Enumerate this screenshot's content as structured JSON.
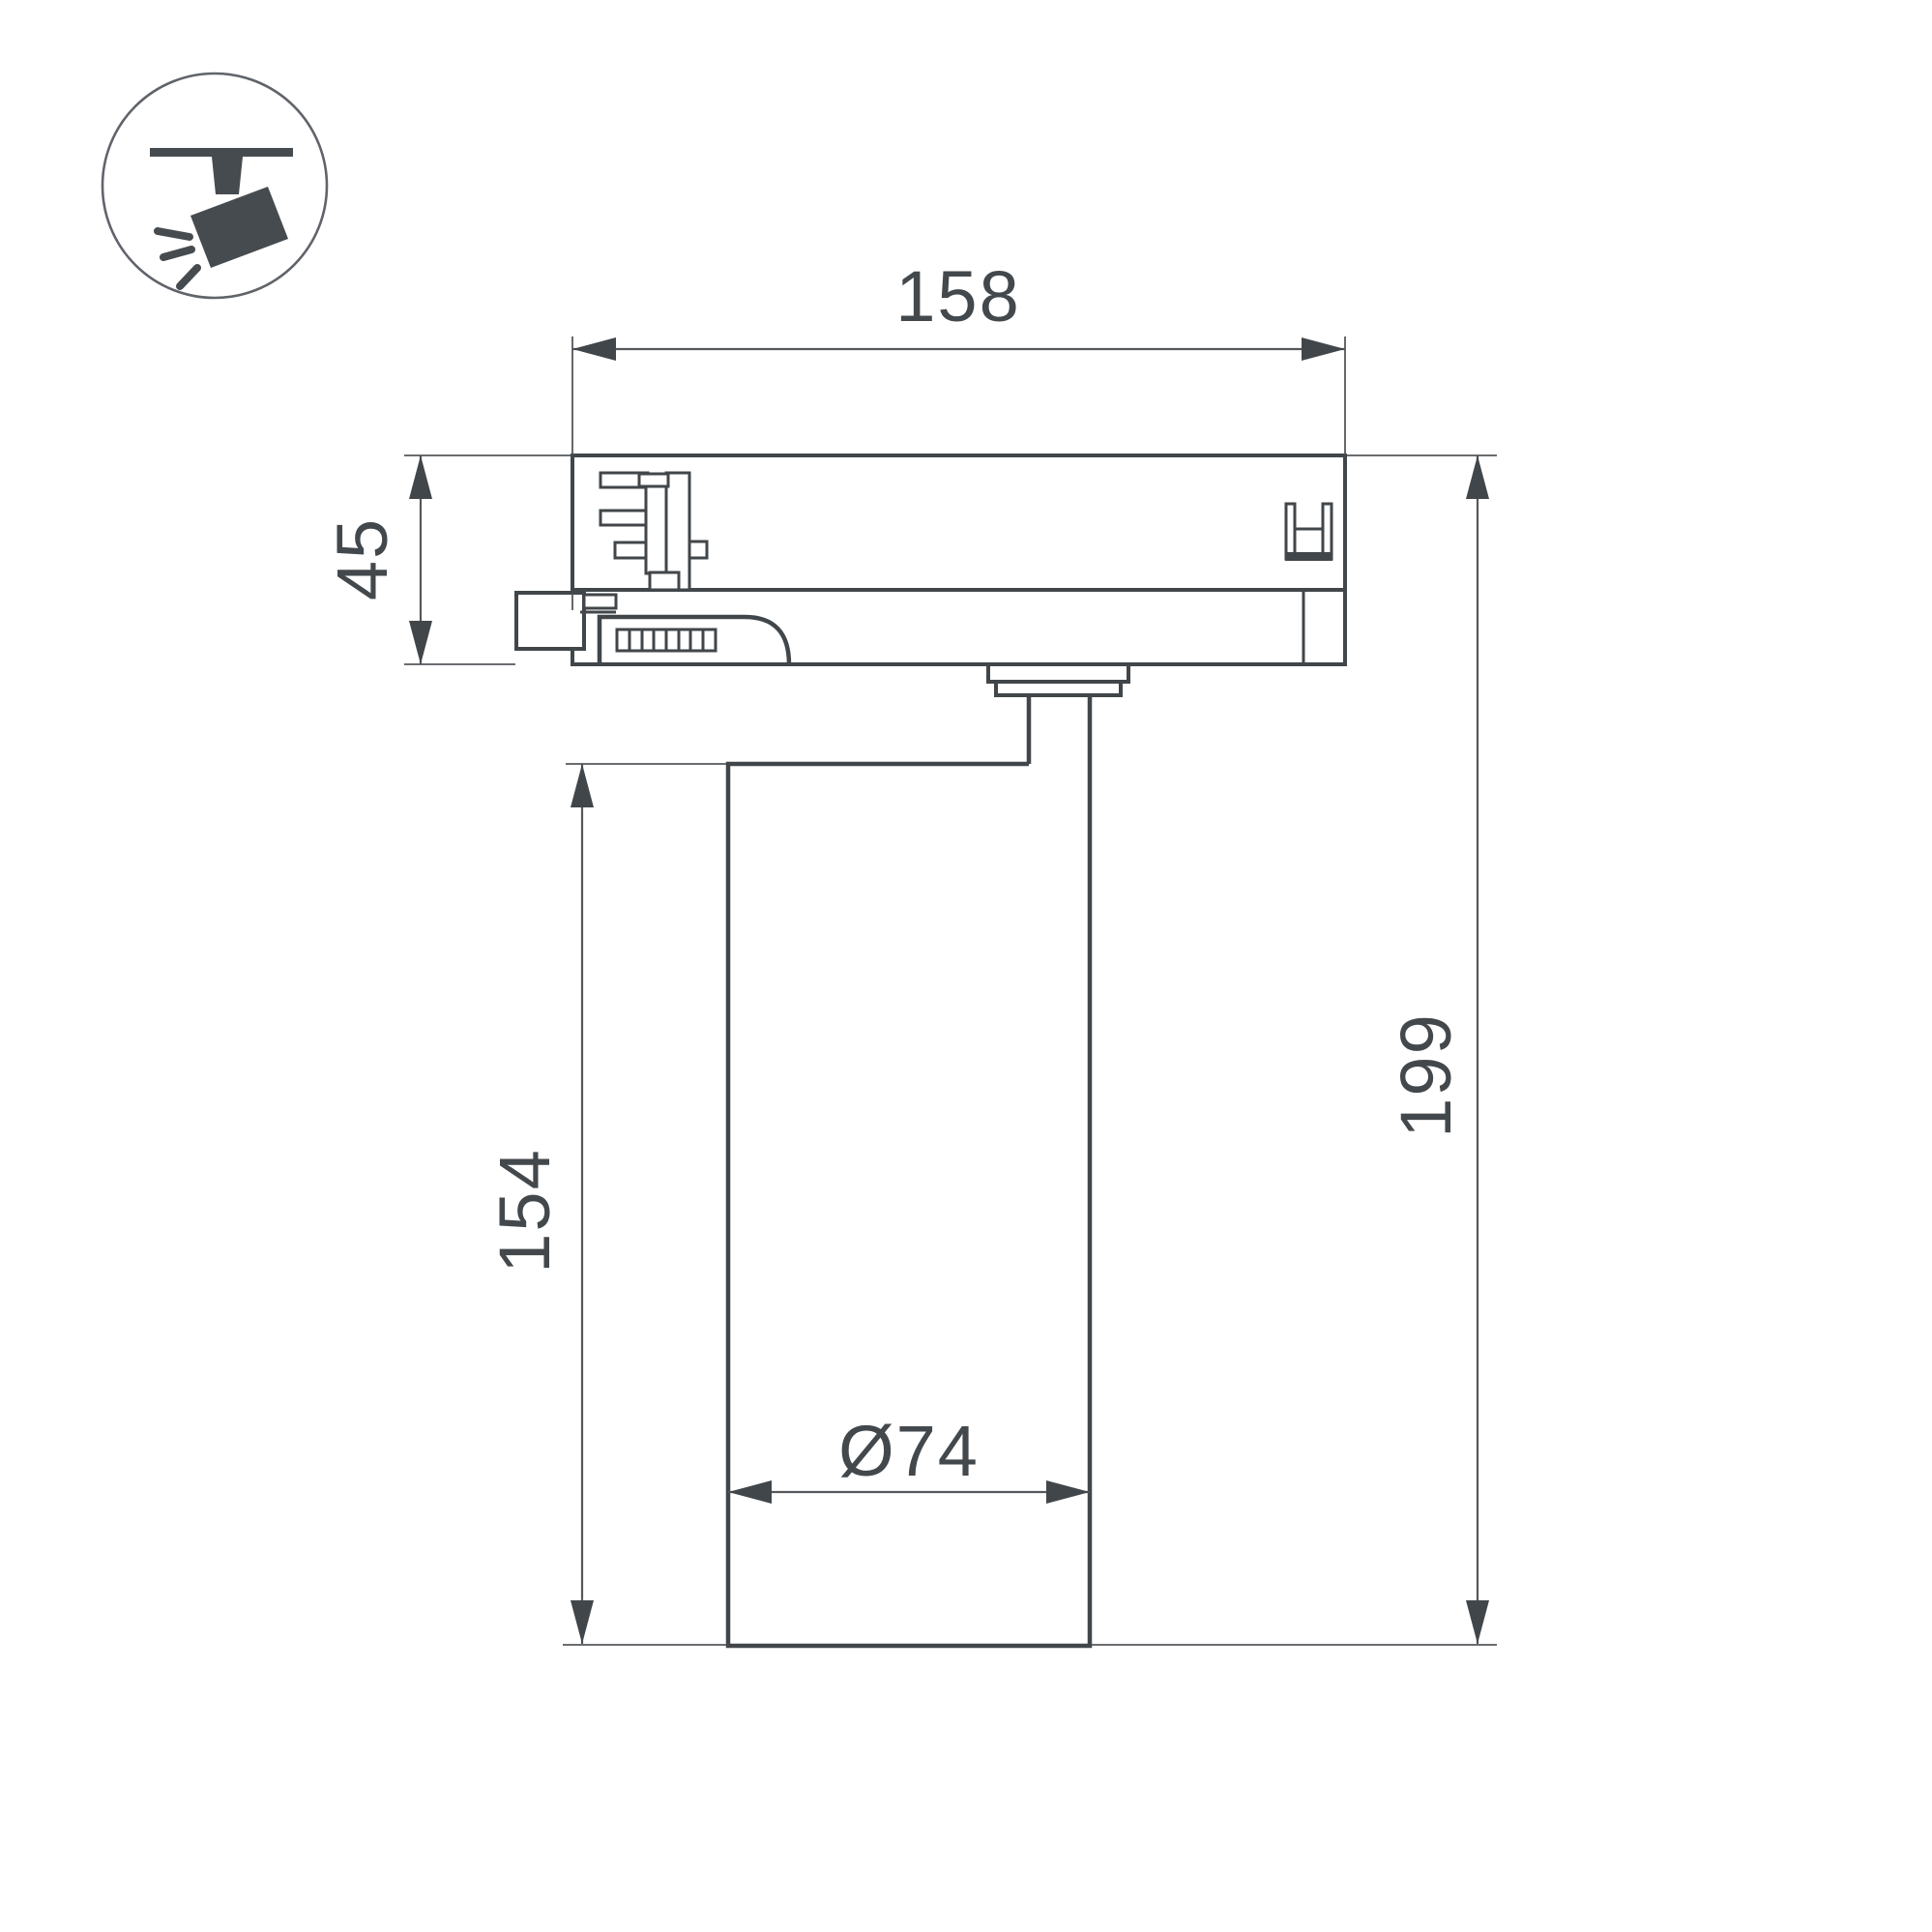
{
  "icon": {
    "name": "track-spotlight-icon"
  },
  "dimensions": {
    "width_top": "158",
    "adapter_height": "45",
    "body_height": "154",
    "total_height": "199",
    "diameter": "Ø74"
  },
  "colors": {
    "background": "#ffffff",
    "line": "#41464a",
    "dim": "#54585c",
    "text": "#43484c",
    "icon": "#464b50"
  }
}
